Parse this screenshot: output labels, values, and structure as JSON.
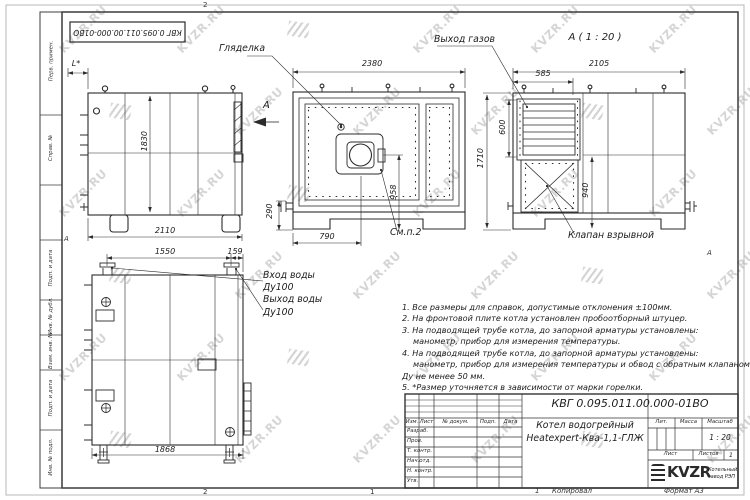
{
  "watermark": {
    "text": "KVZR.RU"
  },
  "doc": {
    "number": "КВГ 0.095.011.00.000-01ВО"
  },
  "views": {
    "side_left": {
      "dim_l": "L*",
      "dim_height": "1830",
      "dim_depth": "2110"
    },
    "front": {
      "callout_sight_glass": "Гляделка",
      "callout_see_item": "См.п.2",
      "view_arrow_label": "А",
      "dim_width": "2380",
      "dim_burner_axis": "958",
      "dim_burner_offset": "790",
      "dim_pipe_height": "290"
    },
    "rear": {
      "title": "А ( 1 : 20 )",
      "callout_gas_outlet": "Выход газов",
      "callout_explosion_valve": "Клапан взрывной",
      "dim_width": "2105",
      "dim_gas_width": "585",
      "dim_gas_height": "600",
      "dim_height": "1710",
      "dim_940": "940"
    },
    "side_right": {
      "label_inlet_line1": "Вход воды",
      "label_inlet_line2": "Ду100",
      "label_outlet_line1": "Выход воды",
      "label_outlet_line2": "Ду100",
      "dim_pipe_span": "1550",
      "dim_pipe_edge": "159",
      "dim_depth": "1868"
    }
  },
  "notes": {
    "lines": [
      "1. Все размеры для справок, допустимые отклонения ±100мм.",
      "2. На фронтовой плите котла установлен пробоотборный штуцер.",
      "3. На подводящей трубе котла, до запорной арматуры установлены:",
      "манометр, прибор для измерения температуры.",
      "4. На подводящей трубе котла, до запорной арматуры установлены:",
      "манометр, прибор для измерения температуры и обвод с обратным клапаном",
      "Ду не менее 50 мм.",
      "5. *Размер уточняется в зависимости от марки горелки."
    ]
  },
  "title_block": {
    "doc_number": "КВГ 0.095.011.00.000-01ВО",
    "product_line1": "Котел водогрейный",
    "product_line2": "Heatexpert-Ква-1,1-ГЛЖ",
    "col_izm": "Изм.",
    "col_list": "Лист",
    "col_doc": "№ докум.",
    "col_podp": "Подп.",
    "col_data": "Дата",
    "row_razrab": "Разраб.",
    "row_prov": "Пров.",
    "row_tkontr": "Т. контр.",
    "row_nachotd": "Нач.отд.",
    "row_nkontr": "Н. контр.",
    "row_utv": "Утв.",
    "lit_label": "Лит.",
    "mass_label": "Масса",
    "scale_label": "Масштаб",
    "scale_value": "1 : 20",
    "sheet_label": "Лист",
    "sheets_label": "Листов",
    "sheets_value": "1",
    "logo_text": "KVZR",
    "company_line1": "Котельный",
    "company_line2": "завод РЭП"
  },
  "margin": {
    "stamps": [
      "Перв. примен.",
      "Справ. №",
      "Подп. и дата",
      "Инв. № дубл.",
      "Взам. инв. №",
      "Подп. и дата",
      "Инв. № подл."
    ],
    "zone_top": "2",
    "zone_bottom_a": "2",
    "zone_bottom_b": "1",
    "zone_bottom_c": "1",
    "copied_label": "Копировал",
    "format_label": "Формат А3",
    "zone_letter_left": "А",
    "zone_letter_right": "А"
  }
}
